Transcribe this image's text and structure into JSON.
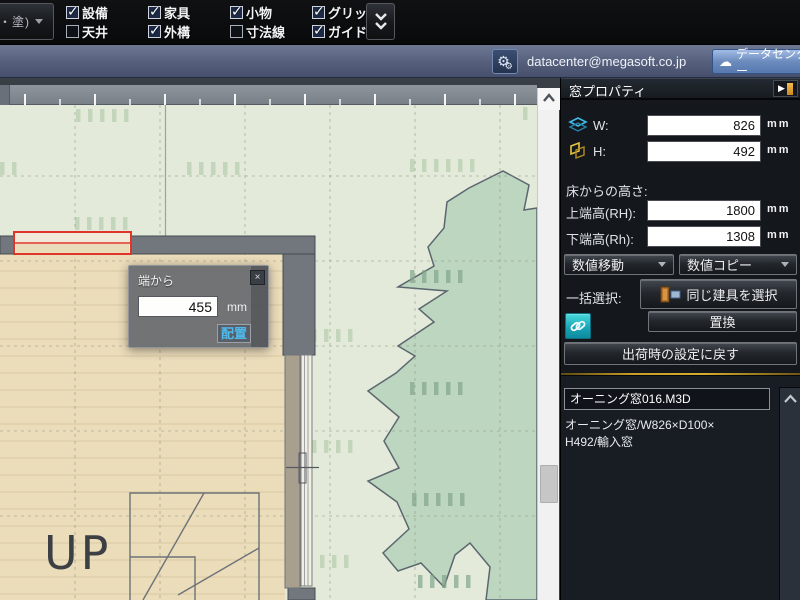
{
  "toolbar": {
    "clipped_button_label": "・塗)",
    "layer_toggles": [
      {
        "label": "設備",
        "checked": true
      },
      {
        "label": "天井",
        "checked": false
      },
      {
        "label": "家具",
        "checked": true
      },
      {
        "label": "外構",
        "checked": true
      },
      {
        "label": "小物",
        "checked": true
      },
      {
        "label": "寸法線",
        "checked": false
      },
      {
        "label": "グリッド",
        "checked": true
      },
      {
        "label": "ガイド線",
        "checked": true
      }
    ]
  },
  "account_bar": {
    "email": "datacenter@megasoft.co.jp",
    "datacenter_button_label": "データセンター"
  },
  "panel": {
    "title": "窓プロパティ",
    "w_label": "W:",
    "w_value": "826",
    "w_unit": "mm",
    "h_label": "H:",
    "h_value": "492",
    "h_unit": "mm",
    "floor_height_label": "床からの高さ:",
    "top_height_label": "上端高(RH):",
    "top_height_value": "1800",
    "top_height_unit": "mm",
    "bottom_height_label": "下端高(Rh):",
    "bottom_height_value": "1308",
    "bottom_height_unit": "mm",
    "numeric_move_dropdown": "数値移動",
    "numeric_copy_dropdown": "数値コピー",
    "batch_select_label": "一括選択:",
    "select_same_fitting_button": "同じ建具を選択",
    "replace_button": "置換",
    "reset_button": "出荷時の設定に戻す",
    "item_name": "オーニング窓016.M3D",
    "item_desc_line1": "オーニング窓/W826×D100×",
    "item_desc_line2": "H492/輸入窓"
  },
  "popup": {
    "title": "端から",
    "distance_value": "455",
    "unit": "mm",
    "place_button": "配置",
    "close_glyph": "×"
  },
  "canvas": {
    "up_label": "UP"
  },
  "colors": {
    "selection_red": "#e0342a",
    "accent_gold": "#d4ac2e",
    "link_teal": "#18a2b4",
    "datacenter_blue": "#5578ae",
    "floor_beige": "#ebdcba",
    "exterior_green": "#e3ead9",
    "tree_green": "#bcd6c0",
    "wall_gray": "#72777e"
  }
}
